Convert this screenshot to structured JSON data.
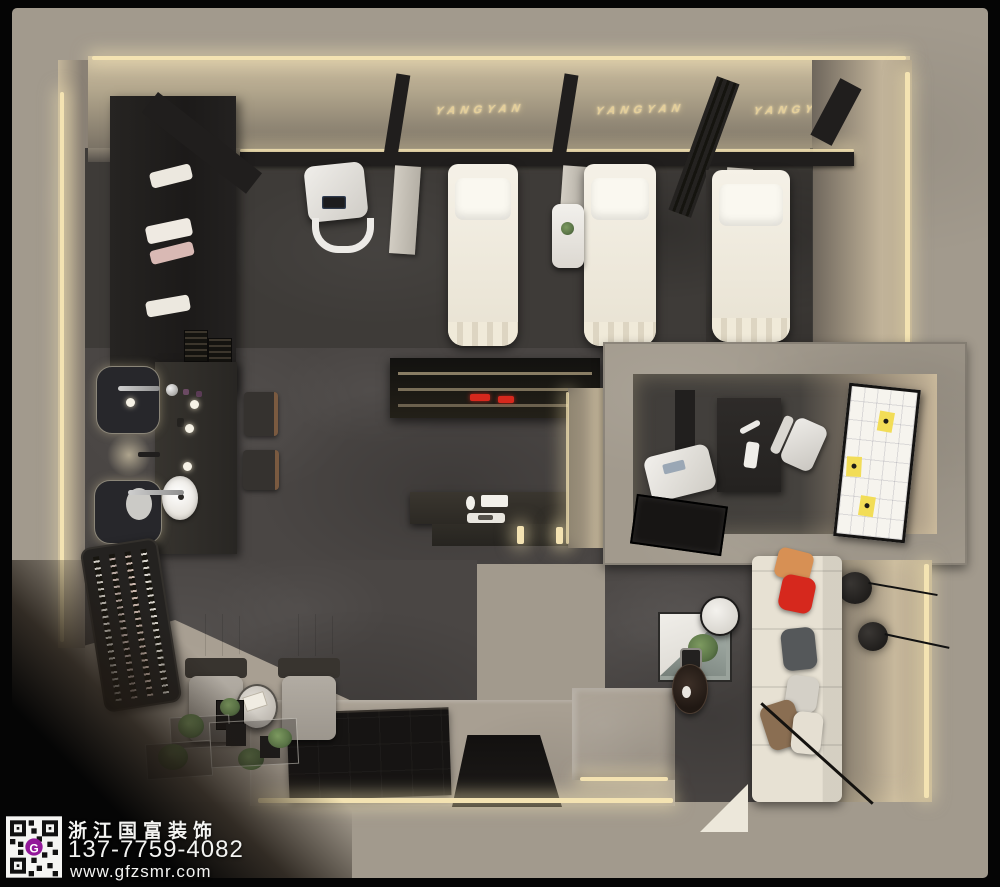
{
  "watermark": {
    "company": "浙江国富装饰",
    "phone": "137-7759-4082",
    "website": "www.gfzsmr.com",
    "qr_center_letter": "G"
  },
  "signage": {
    "brand": "YANGYAN",
    "signs": [
      "YANGYAN",
      "YANGYAN",
      "YANGYAN"
    ]
  },
  "palette": {
    "bg": "#050505",
    "concrete-top": "#a29a8d",
    "concrete-floor": "#a89f92",
    "floor-dark": "#4a4644",
    "floor-darker": "#3e3b38",
    "wood-dark": "#201e1d",
    "led": "#f4e3b2",
    "brand-gold": "#e5cf9a",
    "linen": "#f0ebdf",
    "sofa": "#e7e1d3",
    "accent-red": "#d6281d",
    "sticky-yellow": "#f2dd57",
    "plant": "#5b7547",
    "qr-logo-purple": "#93189a"
  },
  "scene": {
    "view": "top-down 3d interior render of a beauty salon",
    "areas": [
      "treatment-bed-zone",
      "storage-cabinet-wall",
      "vanity-area",
      "pedicure-lounge",
      "retail-display-and-reception",
      "consultation-office",
      "waiting-lounge",
      "entry-platform"
    ],
    "counts": {
      "brand_wall_signs": 3,
      "treatment_beds": 3,
      "hanging_partitions": 3,
      "pedicure_chairs": 2,
      "vanity_basins": 2,
      "wall_mirrors": 2,
      "display_stools": 2,
      "office_sticky_notes": 3,
      "lounge_wall_lamps": 2,
      "sofa_pillows": 5
    }
  }
}
